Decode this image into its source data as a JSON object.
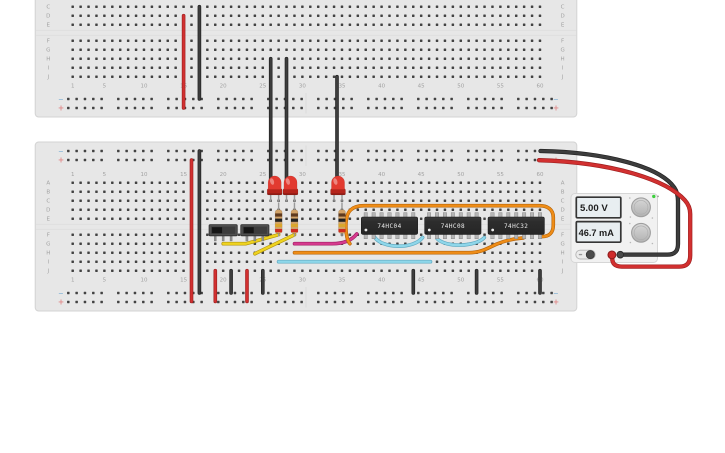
{
  "canvas": {
    "background": "#ffffff"
  },
  "breadboard": {
    "row_letters": [
      "A",
      "B",
      "C",
      "D",
      "E",
      "F",
      "G",
      "H",
      "I",
      "J"
    ],
    "column_numbers": [
      "1",
      "5",
      "10",
      "15",
      "20",
      "25",
      "30",
      "35",
      "40",
      "45",
      "50",
      "55",
      "60"
    ],
    "rail_negative_symbol": "−",
    "rail_positive_symbol": "+",
    "body_color": "#e7e7e7",
    "edge_color": "#d3d3d3",
    "hole_color": "#424242",
    "label_color": "#a2a2a2",
    "negative_symbol_color": "#8ab6d8",
    "positive_symbol_color": "#e08a8a"
  },
  "ics": [
    {
      "label": "74HC04"
    },
    {
      "label": "74HC08"
    },
    {
      "label": "74HC32"
    }
  ],
  "power_supply": {
    "voltage_display": "5.00 V",
    "current_display": "46.7 mA",
    "panel_color": "#f1f1f1",
    "display_bg": "#e8eef1",
    "display_frame": "#353535",
    "power_led_color": "#3ecf3e",
    "knob_stroke": "#9f9f9f",
    "positive_terminal_color": "#cf2a2a",
    "negative_terminal_color": "#4a4a4a"
  },
  "components": {
    "led_color": "#e23a30",
    "led_flange_color": "#b5241b",
    "resistor_body_color": "#d2a368",
    "resistor_band_colors": [
      "#5e3a1e",
      "#212121",
      "#d9a62e",
      "#cf2a1f"
    ],
    "switch_body_color": "#4f4f4f",
    "switch_knob_color": "#161616",
    "ic_body_color": "#2d2d2d",
    "pin_color": "#b5b5b5",
    "lead_color": "#9a9a9a"
  },
  "wire_colors": {
    "red": {
      "main": "#d23030",
      "dark": "#9e1f1f"
    },
    "black": {
      "main": "#3d3d3d",
      "dark": "#1f1f1f"
    },
    "yellow": {
      "main": "#efd320",
      "dark": "#b1940b"
    },
    "orange": {
      "main": "#ef8d17",
      "dark": "#b5640a"
    },
    "cyan": {
      "main": "#8fd7ea",
      "dark": "#5fa8c0"
    },
    "magenta": {
      "main": "#d63a8e",
      "dark": "#a32066"
    }
  }
}
